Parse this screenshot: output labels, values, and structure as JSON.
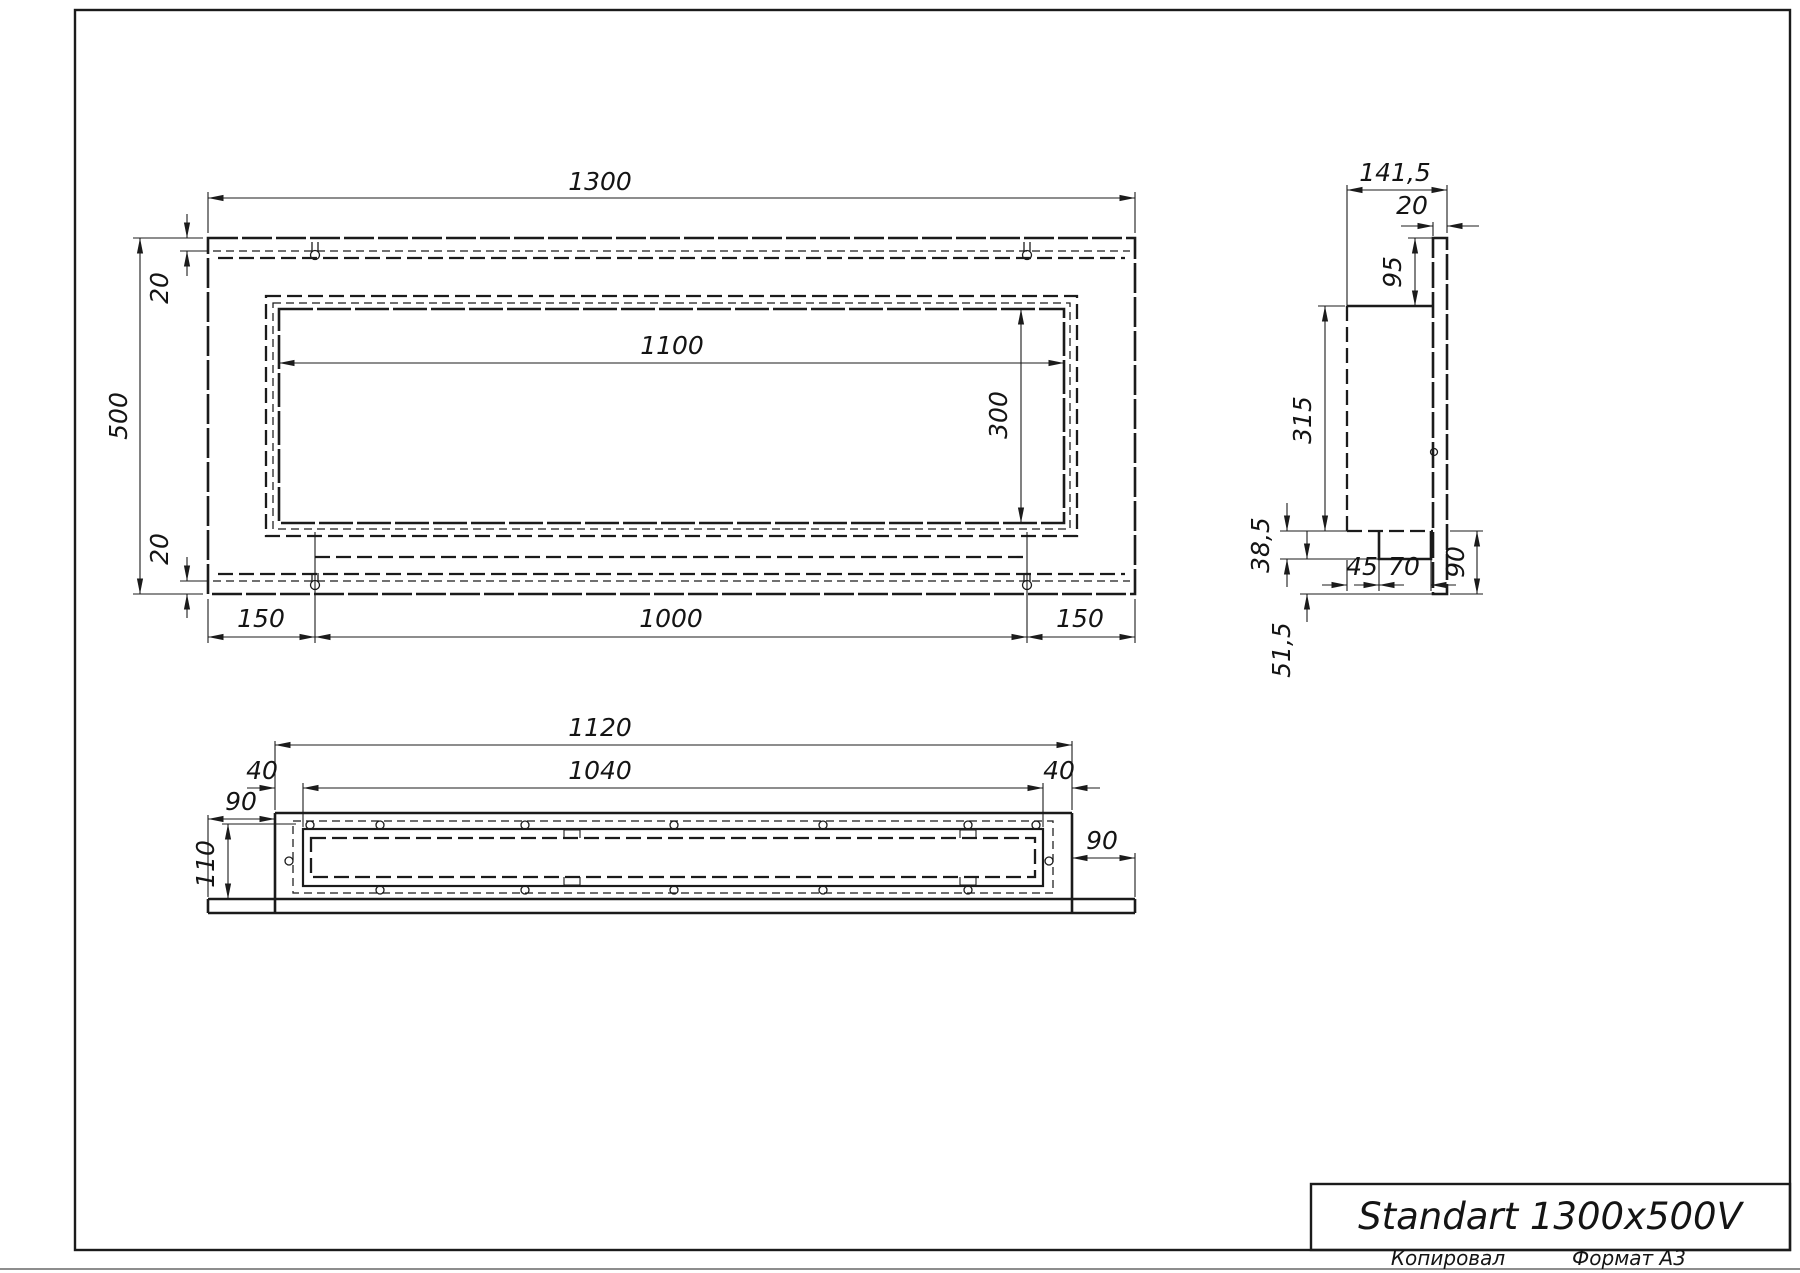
{
  "colors": {
    "ink": "#1b1b1b",
    "paper": "#ffffff"
  },
  "title_block": {
    "product_name": "Standart 1300x500V",
    "copied_label": "Копировал",
    "format_label": "Формат А3"
  },
  "views": {
    "front": {
      "dims": {
        "overall_width": "1300",
        "overall_height": "500",
        "flange_top": "20",
        "flange_bottom": "20",
        "opening_width": "1100",
        "opening_height": "300",
        "offset_left": "150",
        "holes_span": "1000",
        "offset_right": "150"
      }
    },
    "side": {
      "dims": {
        "overall_depth": "141,5",
        "panel_thickness": "20",
        "top_offset": "95",
        "box_height": "315",
        "tray_height": "38,5",
        "tray_offset": "45",
        "tray_width": "70",
        "lower_height": "90",
        "bottom_offset": "51,5"
      }
    },
    "bottom": {
      "dims": {
        "box_width": "1120",
        "inner_width": "1040",
        "inner_margin_left": "40",
        "inner_margin_right": "40",
        "overhang_left": "90",
        "inner_depth": "110",
        "overhang_right": "90"
      }
    }
  }
}
